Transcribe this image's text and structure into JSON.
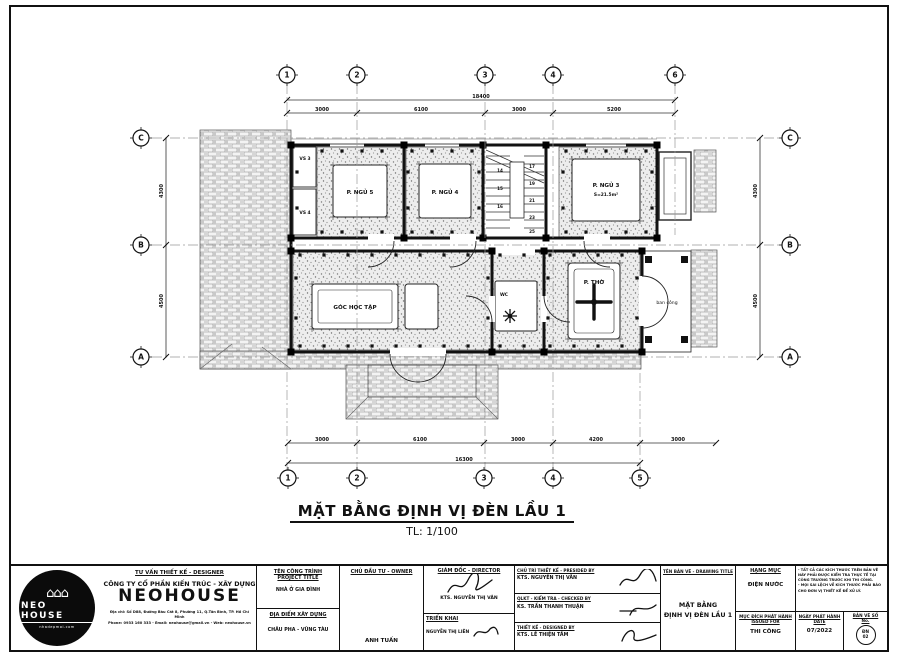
{
  "sheet": {
    "title": "MẶT BẰNG ĐỊNH VỊ ĐÈN LẦU 1",
    "scale": "TL: 1/100"
  },
  "plan": {
    "grid": {
      "top": [
        "1",
        "2",
        "3",
        "4",
        "6"
      ],
      "bottom": [
        "1",
        "2",
        "3",
        "4",
        "5"
      ],
      "left": [
        "C",
        "B",
        "A"
      ],
      "right": [
        "C",
        "B",
        "A"
      ]
    },
    "dims": {
      "top_overall": "18400",
      "top": [
        "3000",
        "6100",
        "3000",
        "5200"
      ],
      "bottom": [
        "3000",
        "6100",
        "3000",
        "4200",
        "3000"
      ],
      "bottom_overall": "16300",
      "left": [
        "4300",
        "4500"
      ],
      "right": [
        "4300",
        "4500"
      ]
    },
    "rooms": {
      "vs3": "VS 3",
      "vs4": "VS 4",
      "bed5": "P. NGỦ 5",
      "bed4": "P. NGỦ 4",
      "bed3": "P. NGỦ 3",
      "bed3_area": "S=21.5m²",
      "study": "GÓC HỌC TẬP",
      "wc": "WC",
      "worship": "P. THỜ",
      "balcony": "ban công"
    },
    "stairs": {
      "left": [
        "14",
        "15",
        "16"
      ],
      "right": [
        "17",
        "19",
        "21",
        "23",
        "25"
      ]
    },
    "lights": [
      [
        322,
        151
      ],
      [
        342,
        151
      ],
      [
        362,
        151
      ],
      [
        382,
        151
      ],
      [
        412,
        151
      ],
      [
        432,
        151
      ],
      [
        452,
        151
      ],
      [
        472,
        151
      ],
      [
        566,
        151
      ],
      [
        586,
        151
      ],
      [
        606,
        151
      ],
      [
        626,
        151
      ],
      [
        646,
        151
      ],
      [
        322,
        232
      ],
      [
        342,
        232
      ],
      [
        362,
        232
      ],
      [
        382,
        232
      ],
      [
        412,
        232
      ],
      [
        432,
        232
      ],
      [
        452,
        232
      ],
      [
        472,
        232
      ],
      [
        566,
        232
      ],
      [
        586,
        232
      ],
      [
        606,
        232
      ],
      [
        626,
        232
      ],
      [
        646,
        232
      ],
      [
        300,
        255
      ],
      [
        324,
        255
      ],
      [
        348,
        255
      ],
      [
        372,
        255
      ],
      [
        396,
        255
      ],
      [
        420,
        255
      ],
      [
        444,
        255
      ],
      [
        468,
        255
      ],
      [
        500,
        255
      ],
      [
        524,
        255
      ],
      [
        550,
        255
      ],
      [
        574,
        255
      ],
      [
        598,
        255
      ],
      [
        622,
        255
      ],
      [
        300,
        346
      ],
      [
        324,
        346
      ],
      [
        348,
        346
      ],
      [
        372,
        346
      ],
      [
        396,
        346
      ],
      [
        420,
        346
      ],
      [
        444,
        346
      ],
      [
        468,
        346
      ],
      [
        500,
        346
      ],
      [
        524,
        346
      ],
      [
        550,
        346
      ],
      [
        574,
        346
      ],
      [
        598,
        346
      ],
      [
        622,
        346
      ],
      [
        297,
        172
      ],
      [
        297,
        208
      ],
      [
        408,
        172
      ],
      [
        408,
        208
      ],
      [
        479,
        172
      ],
      [
        479,
        208
      ],
      [
        563,
        172
      ],
      [
        563,
        208
      ],
      [
        652,
        172
      ],
      [
        652,
        208
      ],
      [
        296,
        278
      ],
      [
        296,
        318
      ],
      [
        488,
        278
      ],
      [
        488,
        318
      ],
      [
        548,
        278
      ],
      [
        548,
        318
      ],
      [
        637,
        278
      ],
      [
        637,
        318
      ]
    ],
    "crosses": [
      [
        333,
        165
      ],
      [
        387,
        165
      ],
      [
        333,
        217
      ],
      [
        387,
        217
      ],
      [
        419,
        164
      ],
      [
        471,
        164
      ],
      [
        419,
        218
      ],
      [
        471,
        218
      ],
      [
        572,
        159
      ],
      [
        640,
        159
      ],
      [
        572,
        221
      ],
      [
        640,
        221
      ],
      [
        312,
        284
      ],
      [
        398,
        284
      ],
      [
        312,
        329
      ],
      [
        398,
        329
      ],
      [
        568,
        263
      ],
      [
        620,
        263
      ],
      [
        568,
        339
      ],
      [
        620,
        339
      ]
    ]
  },
  "titleblock": {
    "logo": {
      "name": "NEO HOUSE",
      "tagline": "nhadepmoi.com",
      "houses": "⌂⌂⌂"
    },
    "company": {
      "role": "TƯ VẤN THIẾT KẾ - DESIGNER",
      "name_prefix": "CÔNG TY CỔ PHẦN KIẾN TRÚC - XÂY DỰNG",
      "brand": "NEOHOUSE",
      "address": "Địa chỉ: Số D88, Đường Bàu Cát 8, Phường 11, Q.Tân Bình, TP. Hồ Chí Minh",
      "contact": "Phone: 0933 160 333 - Email: neohouse@gmail.vn - Web: neohouse.vn"
    },
    "project": {
      "label": "TÊN CÔNG TRÌNH",
      "label_en": "PROJECT TITLE",
      "value": "NHÀ Ở GIA ĐÌNH",
      "location_label": "ĐỊA ĐIỂM XÂY DỰNG",
      "location": "CHÂU PHA - VŨNG TÀU"
    },
    "owner": {
      "label": "CHỦ ĐẦU TƯ - OWNER",
      "value": "ANH TUẤN"
    },
    "director": {
      "label": "GIÁM ĐỐC - DIRECTOR",
      "value": "KTS. NGUYỄN THỊ VÂN",
      "deploy_label": "TRIỂN KHAI",
      "deploy_value": "NGUYỄN THỊ LIÊN"
    },
    "team": [
      {
        "label": "CHỦ TRÌ THIẾT KẾ - PRESIDED BY",
        "value": "KTS. NGUYỄN THỊ VÂN"
      },
      {
        "label": "QLKT - KIỂM TRA - CHECKED BY",
        "value": "KS. TRẦN THANH THUẬN"
      },
      {
        "label": "THIẾT KẾ - DESIGNED BY",
        "value": "KTS. LÊ THIỆN TÂM"
      }
    ],
    "drawing": {
      "label": "TÊN BẢN VẼ - DRAWING TITLE",
      "value_line1": "MẶT BẰNG",
      "value_line2": "ĐỊNH VỊ ĐÈN LẦU 1"
    },
    "category": {
      "label": "HẠNG MỤC",
      "value": "ĐIỆN NƯỚC"
    },
    "issued": {
      "label": "MỤC ĐÍCH PHÁT HÀNH",
      "label_en": "ISSUED FOR",
      "value": "THI CÔNG"
    },
    "notes": [
      "- TẤT CẢ CÁC KÍCH THƯỚC TRÊN BẢN VẼ NÀY PHẢI ĐƯỢC KIỂM TRA THỰC TẾ TẠI CÔNG TRƯỜNG TRƯỚC KHI THI CÔNG.",
      "- MỌI SAI LỆCH VỀ KÍCH THƯỚC PHẢI BÁO CHO ĐƠN VỊ THIẾT KẾ ĐỂ XỬ LÝ."
    ],
    "date": {
      "label": "NGÀY PHÁT HÀNH",
      "label_en": "DATE",
      "value": "07/2022"
    },
    "number": {
      "label": "BẢN VẼ SỐ",
      "label_en": "No.",
      "value_line1": "ĐN",
      "value_line2": "02"
    }
  }
}
